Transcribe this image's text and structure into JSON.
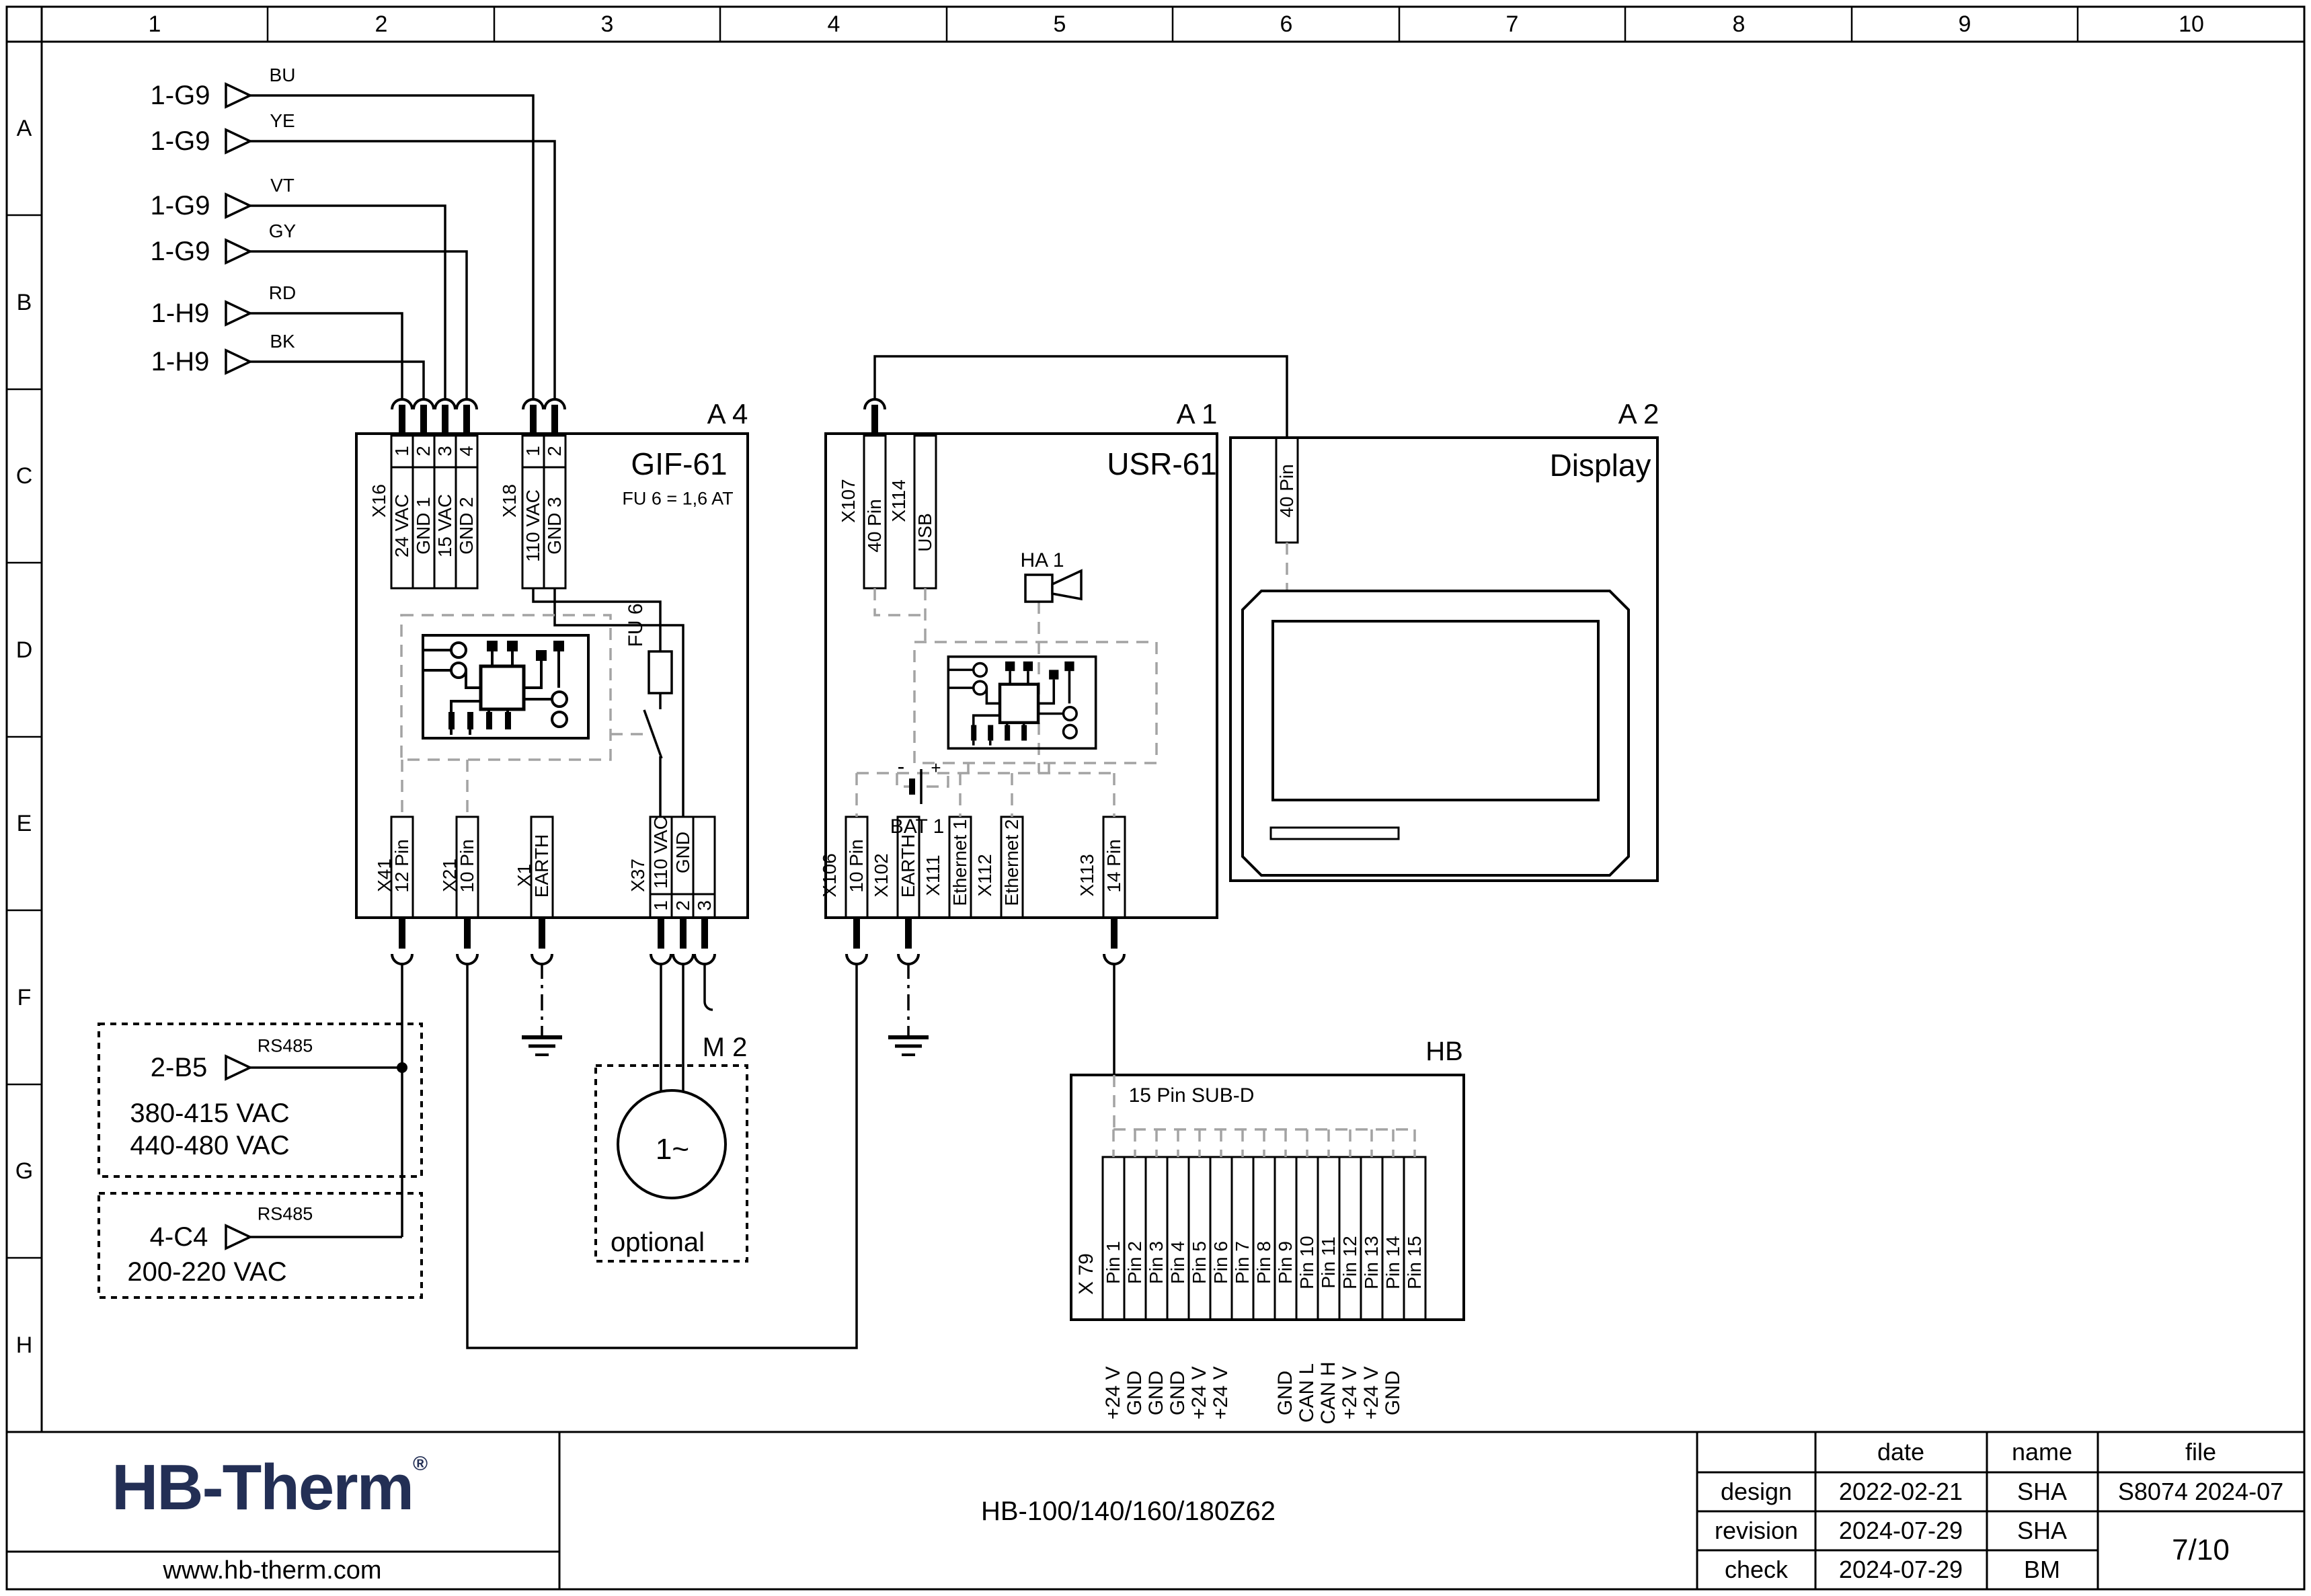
{
  "page": {
    "grid_columns": [
      "1",
      "2",
      "3",
      "4",
      "5",
      "6",
      "7",
      "8",
      "9",
      "10"
    ],
    "grid_rows": [
      "A",
      "B",
      "C",
      "D",
      "E",
      "F",
      "G",
      "H"
    ]
  },
  "sources": {
    "s1": {
      "ref": "1-G9",
      "color": "BU"
    },
    "s2": {
      "ref": "1-G9",
      "color": "YE"
    },
    "s3": {
      "ref": "1-G9",
      "color": "VT"
    },
    "s4": {
      "ref": "1-G9",
      "color": "GY"
    },
    "s5": {
      "ref": "1-H9",
      "color": "RD"
    },
    "s6": {
      "ref": "1-H9",
      "color": "BK"
    }
  },
  "a4": {
    "ref": "A 4",
    "title": "GIF-61",
    "fuse_note": "FU 6 = 1,6 AT",
    "fuse_label": "FU 6",
    "x16": {
      "name": "X16",
      "p1": "1",
      "p2": "2",
      "p3": "3",
      "p4": "4",
      "s1": "24 VAC",
      "s2": "GND 1",
      "s3": "15 VAC",
      "s4": "GND 2"
    },
    "x18": {
      "name": "X18",
      "p1": "1",
      "p2": "2",
      "s1": "110 VAC",
      "s2": "GND 3"
    },
    "x41": {
      "name": "X41",
      "signal": "12 Pin"
    },
    "x21": {
      "name": "X21",
      "signal": "10 Pin"
    },
    "x1": {
      "name": "X1",
      "signal": "EARTH"
    },
    "x37": {
      "name": "X37",
      "p1": "1",
      "p2": "2",
      "p3": "3",
      "s1": "110 VAC",
      "s2": "GND"
    }
  },
  "a1": {
    "ref": "A 1",
    "title": "USR-61",
    "horn": "HA 1",
    "battery": "BAT 1",
    "minus": "-",
    "plus": "+",
    "x107": {
      "name": "X107",
      "signal": "40 Pin"
    },
    "x114": {
      "name": "X114",
      "signal": "USB"
    },
    "x106": {
      "name": "X106",
      "signal": "10 Pin"
    },
    "x102": {
      "name": "X102",
      "signal": "EARTH"
    },
    "x111": {
      "name": "X111",
      "signal": "Ethernet 1"
    },
    "x112": {
      "name": "X112",
      "signal": "Ethernet 2"
    },
    "x113": {
      "name": "X113",
      "signal": "14 Pin"
    }
  },
  "a2": {
    "ref": "A 2",
    "title": "Display",
    "connector": "40 Pin"
  },
  "m2": {
    "ref": "M 2",
    "symbol": "1~",
    "note": "optional"
  },
  "hb": {
    "ref": "HB",
    "header": "15 Pin SUB-D",
    "connector": "X 79",
    "pins": [
      "Pin 1",
      "Pin 2",
      "Pin 3",
      "Pin 4",
      "Pin 5",
      "Pin 6",
      "Pin 7",
      "Pin 8",
      "Pin 9",
      "Pin 10",
      "Pin 11",
      "Pin 12",
      "Pin 13",
      "Pin 14",
      "Pin 15"
    ],
    "signals": [
      "+24 V",
      "GND",
      "GND",
      "GND",
      "+24 V",
      "+24 V",
      "",
      "",
      "GND",
      "CAN L",
      "CAN H",
      "+24 V",
      "+24 V",
      "GND",
      ""
    ]
  },
  "feeds": {
    "f1": {
      "ref": "2-B5",
      "bus": "RS485",
      "v1": "380-415 VAC",
      "v2": "440-480 VAC"
    },
    "f2": {
      "ref": "4-C4",
      "bus": "RS485",
      "v1": "200-220 VAC"
    }
  },
  "titleblock": {
    "logo": "HB-Therm",
    "registered": "®",
    "logo_color": "#232f55",
    "website": "www.hb-therm.com",
    "doc_title": "HB-100/140/160/180Z62",
    "col_date": "date",
    "col_name": "name",
    "col_file": "file",
    "row_design": "design",
    "row_revision": "revision",
    "row_check": "check",
    "design_date": "2022-02-21",
    "design_name": "SHA",
    "revision_date": "2024-07-29",
    "revision_name": "SHA",
    "check_date": "2024-07-29",
    "check_name": "BM",
    "file_value": "S8074 2024-07",
    "page": "7/10"
  }
}
